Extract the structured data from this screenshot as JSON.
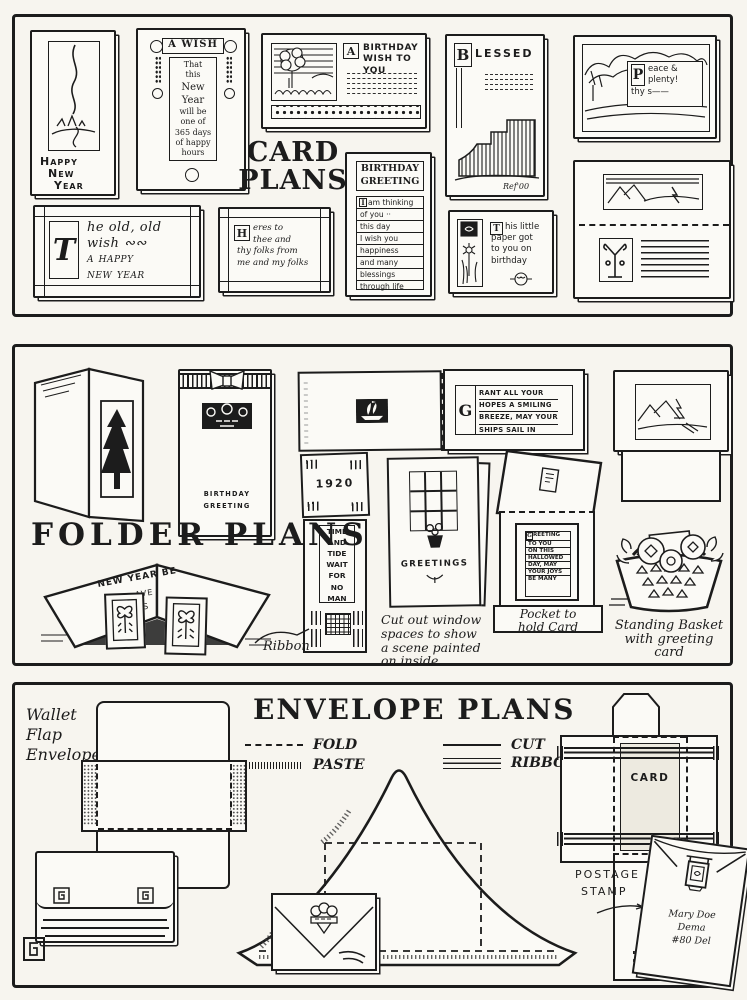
{
  "palette": {
    "paper": "#f7f5ef",
    "card": "#fbfaf6",
    "ink": "#1c1c1c"
  },
  "card_panel": {
    "title_line1": "CARD",
    "title_line2": "PLANS",
    "happy_card": {
      "line1": "Happy",
      "line2": "New",
      "line3": "Year"
    },
    "wish_card": {
      "title": "A WISH",
      "lines": [
        "That",
        "this",
        "New",
        "Year",
        "will be",
        "one of",
        "365 days",
        "of happy",
        "hours"
      ]
    },
    "birthday_wish_card": {
      "initial": "A",
      "title_line1": "BIRTHDAY",
      "title_line2": "WISH TO YOU"
    },
    "blessed_card": {
      "initial": "B",
      "title": "LESSED",
      "signature": "Ref'00"
    },
    "peace_card": {
      "initial": "P",
      "lines": [
        "eace &",
        "plenty!",
        "thy s——"
      ]
    },
    "old_wish_card": {
      "initial": "T",
      "lines": [
        "he old, old",
        "wish ∾∾",
        "a happy",
        "new year"
      ]
    },
    "heres_card": {
      "initial": "H",
      "lines": [
        "eres to",
        "thee and",
        "thy folks from",
        "me and my folks"
      ]
    },
    "birthday_greeting_card": {
      "title_line1": "BIRTHDAY",
      "title_line2": "GREETING",
      "initial": "I",
      "lines": [
        "am thinking",
        "of you ··",
        "this day",
        "I wish you",
        "happiness",
        "and many",
        "blessings",
        "through life"
      ]
    },
    "paper_card": {
      "initial": "T",
      "lines": [
        "his little",
        "paper got",
        "to you on",
        "birthday"
      ]
    }
  },
  "folder_panel": {
    "title": "FOLDER PLANS",
    "bow_folder": {
      "line1": "BIRTHDAY",
      "line2": "GREETING"
    },
    "grant_folder": {
      "initial": "G",
      "lines": [
        "RANT ALL YOUR",
        "HOPES A SMILING",
        "BREEZE, MAY YOUR",
        "SHIPS SAIL IN"
      ]
    },
    "bookmark": {
      "year": "1920",
      "lines": [
        "TIME",
        "AND",
        "TIDE",
        "WAIT",
        "FOR",
        "NO",
        "MAN"
      ]
    },
    "ribbon_label": "Ribbon",
    "tent_card": {
      "line1": "NEW YEAR BE",
      "line2": "AVE",
      "line3": "ESS"
    },
    "window_folder": {
      "title": "GREETINGS",
      "caption": [
        "Cut out window",
        "spaces to show",
        "a scene painted",
        "on inside"
      ]
    },
    "pocket_folder": {
      "initial": "G",
      "card_lines": [
        "REETING",
        "TO YOU",
        "ON THIS",
        "HALLOWED",
        "DAY, MAY",
        "YOUR JOYS",
        "BE MANY"
      ],
      "caption_line1": "Pocket to",
      "caption_line2": "hold Card"
    },
    "basket_caption": [
      "Standing Basket",
      "with greeting",
      "card"
    ]
  },
  "envelope_panel": {
    "title": "ENVELOPE PLANS",
    "legend": {
      "fold": "FOLD",
      "paste": "PASTE",
      "cut": "CUT",
      "ribbon": "RIBBON"
    },
    "wallet_label": [
      "Wallet",
      "Flap",
      "Envelope"
    ],
    "card_holder_label": "CARD",
    "postage_label_line1": "POSTAGE",
    "postage_label_line2": "STAMP",
    "address": [
      "Mary Doe",
      "Dema",
      "#80 Del"
    ]
  }
}
